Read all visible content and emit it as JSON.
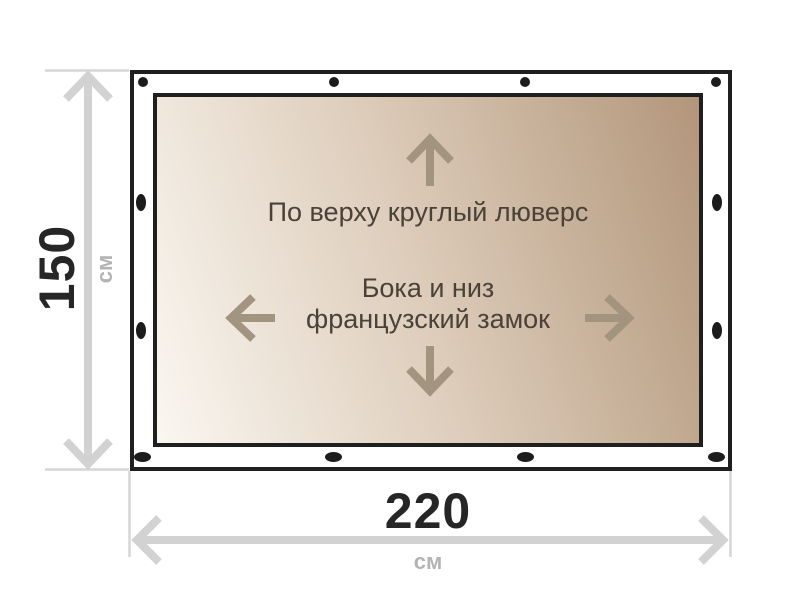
{
  "diagram": {
    "tarp": {
      "top_label": "По верху круглый люверс",
      "center_label_line1": "Бока и низ",
      "center_label_line2": "французский замок"
    },
    "dimensions": {
      "height": {
        "value": "150",
        "unit": "см"
      },
      "width": {
        "value": "220",
        "unit": "см"
      }
    },
    "grommets": {
      "top": 4,
      "bottom": 4,
      "left": 2,
      "right": 2
    },
    "colors": {
      "outline": "#1f1f1f",
      "grommet": "#1c1c1c",
      "tarp_gradient_light": "#faf7f1",
      "tarp_gradient_mid": "#ddccba",
      "tarp_gradient_dark": "#b2967b",
      "tarp_text": "#4a4238",
      "tarp_arrow": "#a3947f",
      "dimension_line": "#d2d2d2",
      "dimension_value": "#262626",
      "dimension_unit": "#b3b3b3"
    }
  }
}
